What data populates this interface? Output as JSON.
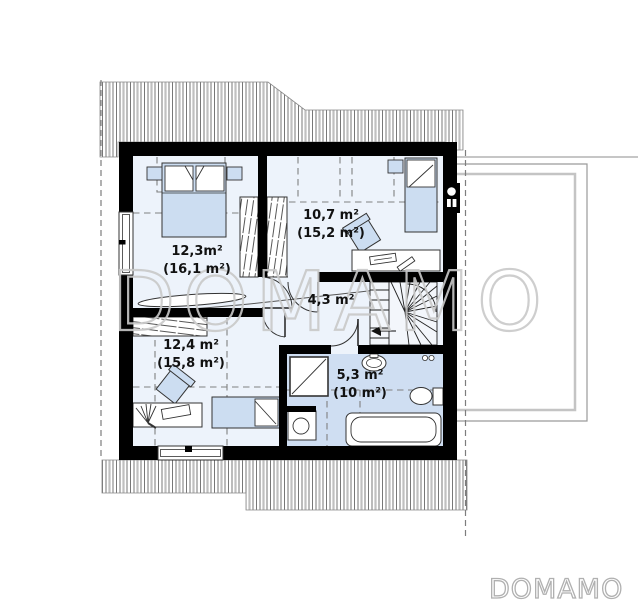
{
  "watermark_text": "DOMAMO",
  "brand_logo_text": "DOMAMO",
  "rooms": {
    "bedroom_top_left": {
      "area": "12,3m²",
      "floor_area": "(16,1 m²)"
    },
    "bedroom_top_right": {
      "area": "10,7 m²",
      "floor_area": "(15,2 m²)"
    },
    "hallway": {
      "area": "4,3 m²"
    },
    "bedroom_bottom_left": {
      "area": "12,4 m²",
      "floor_area": "(15,8 m²)"
    },
    "bathroom": {
      "area": "5,3 m²",
      "floor_area": "(10 m²)"
    }
  },
  "colors": {
    "wall": "#000000",
    "room_floor": "#edf3fb",
    "bathroom_floor": "#cfdef2",
    "furniture": "#ccddf1",
    "dashed_guide": "#808080",
    "watermark_outline": "#c9c9c9",
    "logo_outline": "#b0b0b0"
  }
}
